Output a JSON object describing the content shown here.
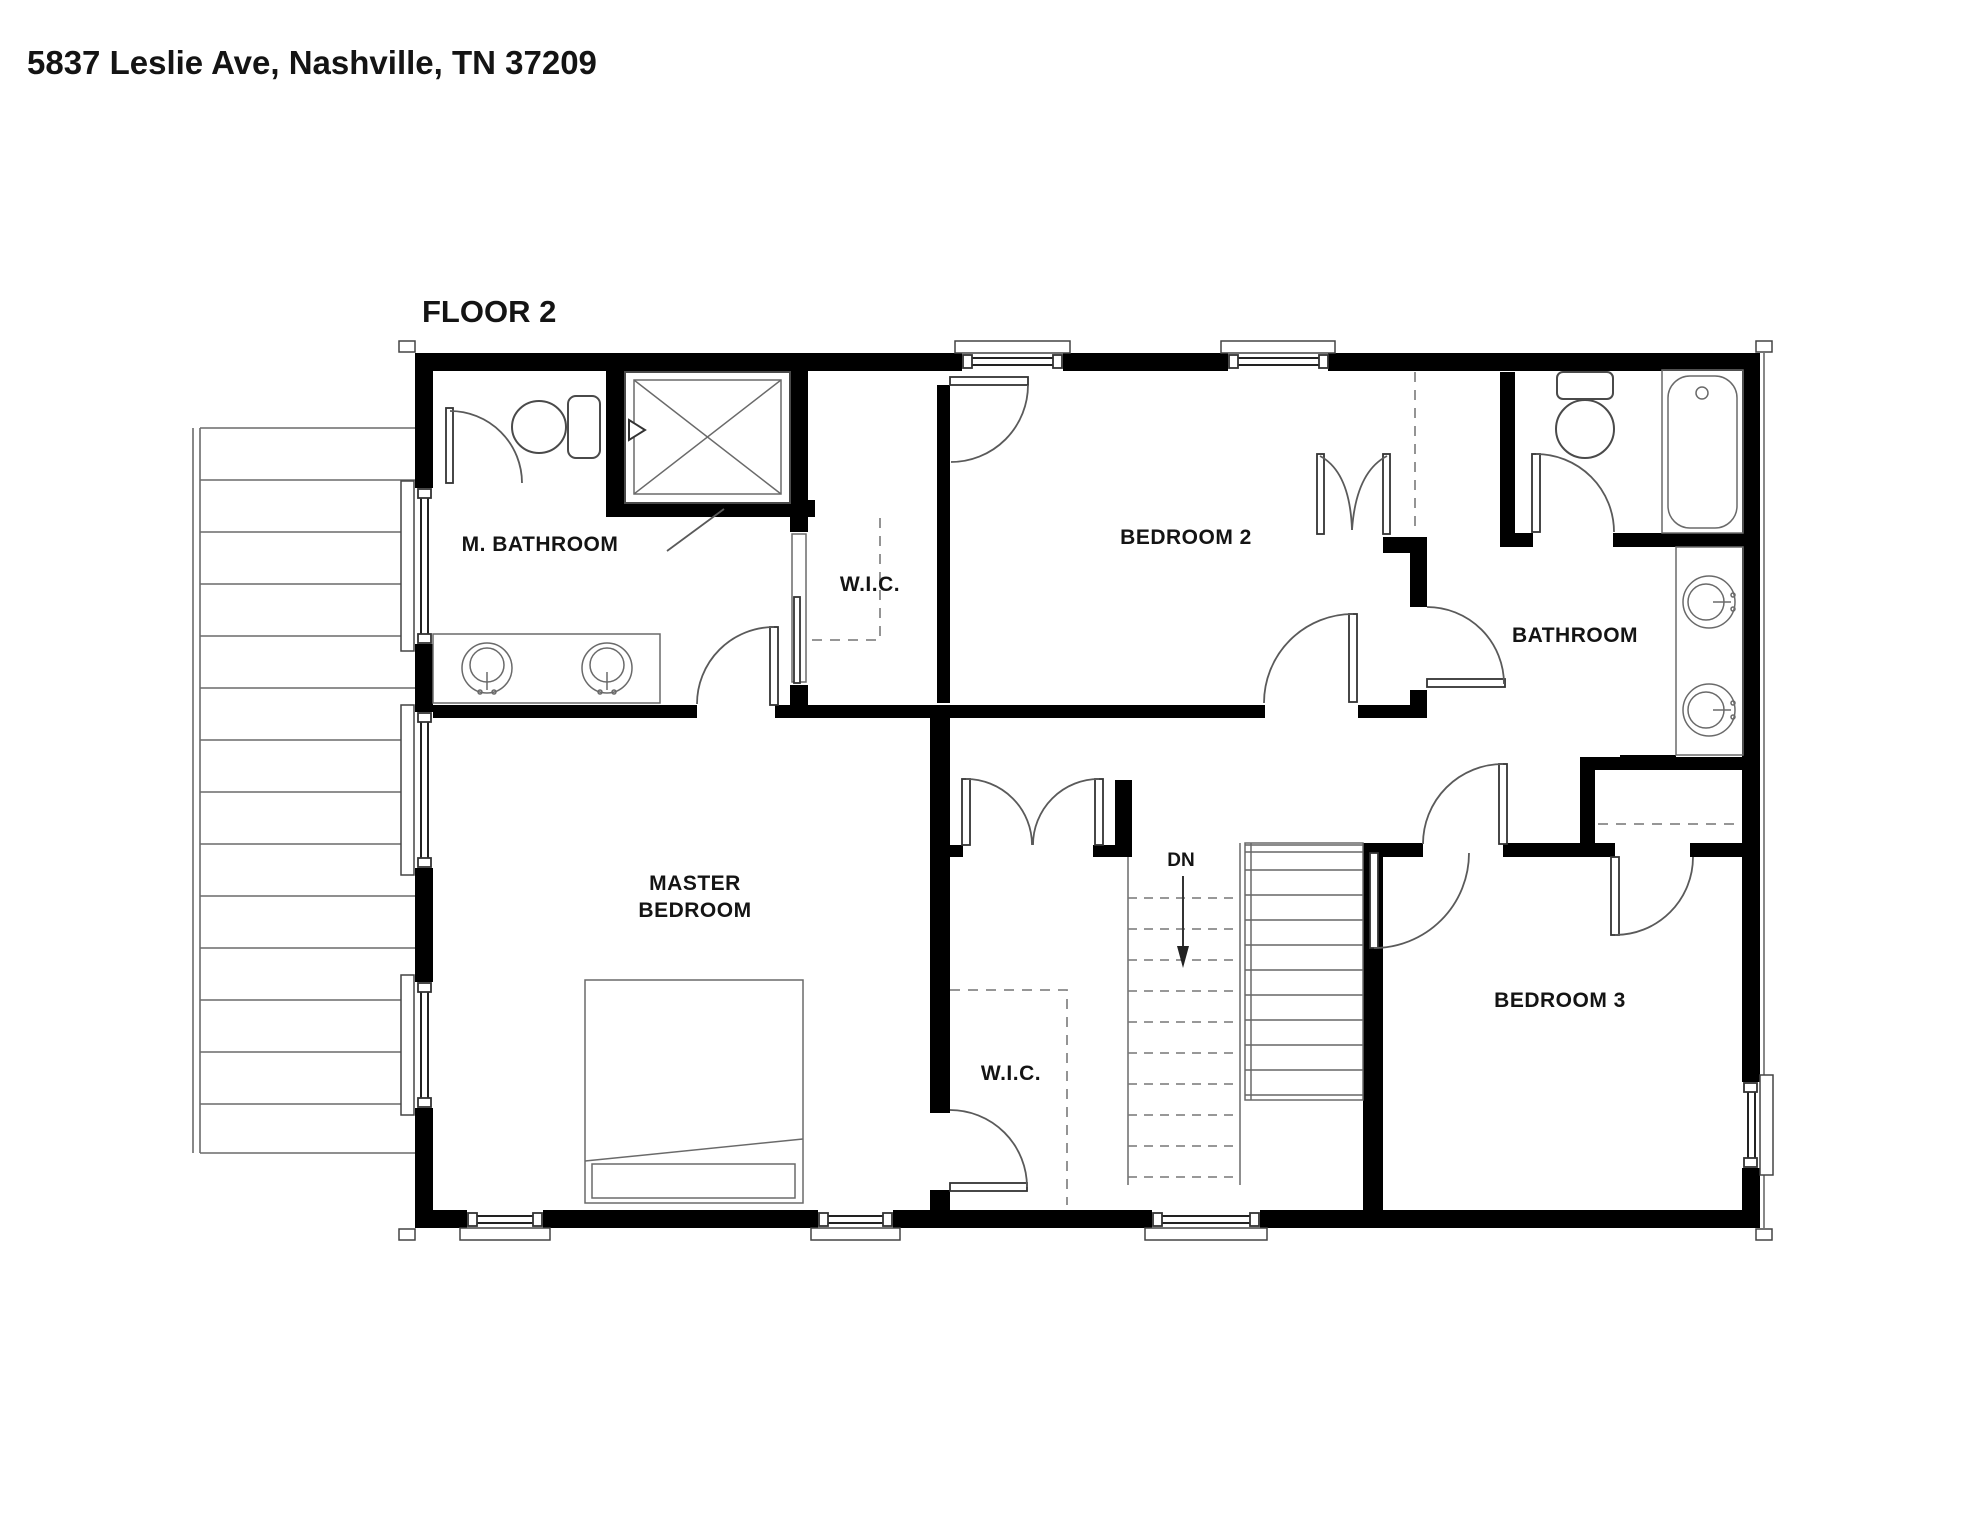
{
  "header": {
    "address_title": "5837 Leslie Ave, Nashville, TN 37209"
  },
  "plan": {
    "floor_label": "FLOOR 2",
    "room_labels": {
      "master_bathroom": "M. BATHROOM",
      "walk_in_closet_upper": "W.I.C.",
      "bedroom_2": "BEDROOM 2",
      "hall_bathroom": "BATHROOM",
      "master_bedroom_line1": "MASTER",
      "master_bedroom_line2": "BEDROOM",
      "walk_in_closet_master": "W.I.C.",
      "bedroom_3": "BEDROOM 3",
      "stair_direction": "DN"
    },
    "fixtures": [
      "toilet",
      "shower",
      "double-vanity-sinks",
      "bathtub",
      "bed",
      "staircase-down",
      "closet-rods",
      "deck"
    ],
    "colors": {
      "background": "#ffffff",
      "wall": "#000000",
      "thin_line": "#4a4a4a",
      "dashed_line": "#888888",
      "text": "#141414"
    }
  }
}
